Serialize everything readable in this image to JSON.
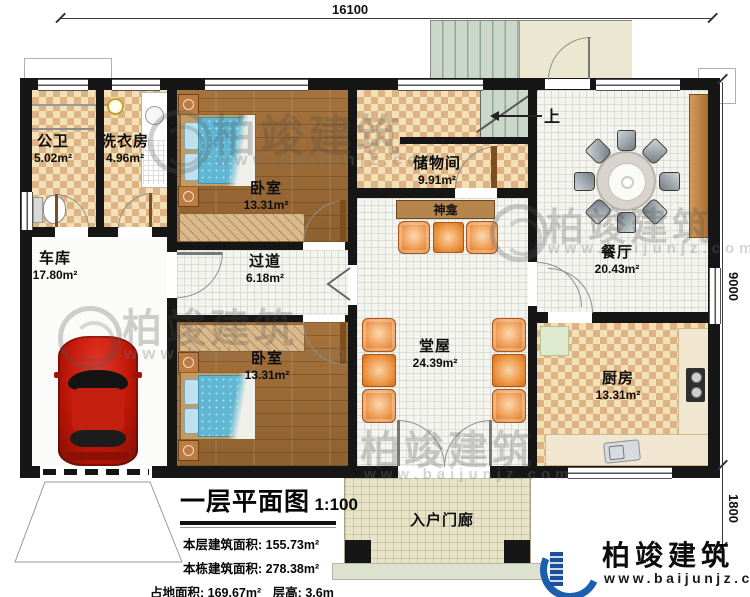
{
  "dimensions": {
    "top": "16100",
    "right": "9000",
    "porch_right": "1800"
  },
  "stairs": {
    "up_label": "上"
  },
  "rooms": {
    "bathroom": {
      "name": "公卫",
      "area": "5.02m²"
    },
    "laundry": {
      "name": "洗衣房",
      "area": "4.96m²"
    },
    "bedroom1": {
      "name": "卧室",
      "area": "13.31m²"
    },
    "storage": {
      "name": "储物间",
      "area": "9.91m²"
    },
    "dining": {
      "name": "餐厅",
      "area": "20.43m²"
    },
    "garage": {
      "name": "车库",
      "area": "17.80m²"
    },
    "hallway": {
      "name": "过道",
      "area": "6.18m²"
    },
    "bedroom2": {
      "name": "卧室",
      "area": "13.31m²"
    },
    "hall": {
      "name": "堂屋",
      "area": "24.39m²"
    },
    "kitchen": {
      "name": "厨房",
      "area": "13.31m²"
    },
    "porch": {
      "name": "入户门廊"
    },
    "shrine": {
      "name": "神龛"
    }
  },
  "title_block": {
    "title": "一层平面图",
    "scale": "1:100",
    "rows": [
      {
        "label": "本层建筑面积:",
        "value": "155.73m²"
      },
      {
        "label": "本栋建筑面积:",
        "value": "278.38m²"
      },
      {
        "label": "占地面积:",
        "value": "169.67m²",
        "label2": "层高:",
        "value2": "3.6m"
      }
    ]
  },
  "brand": {
    "name": "柏竣建筑",
    "website": "www.baijunjz.com"
  },
  "colors": {
    "wall": "#161616",
    "checker": "#ddb383",
    "wood": "#9a6a38",
    "accent_orange": "#e8872f",
    "brand_blue": "#1b5fae",
    "car_red": "#c01708"
  }
}
